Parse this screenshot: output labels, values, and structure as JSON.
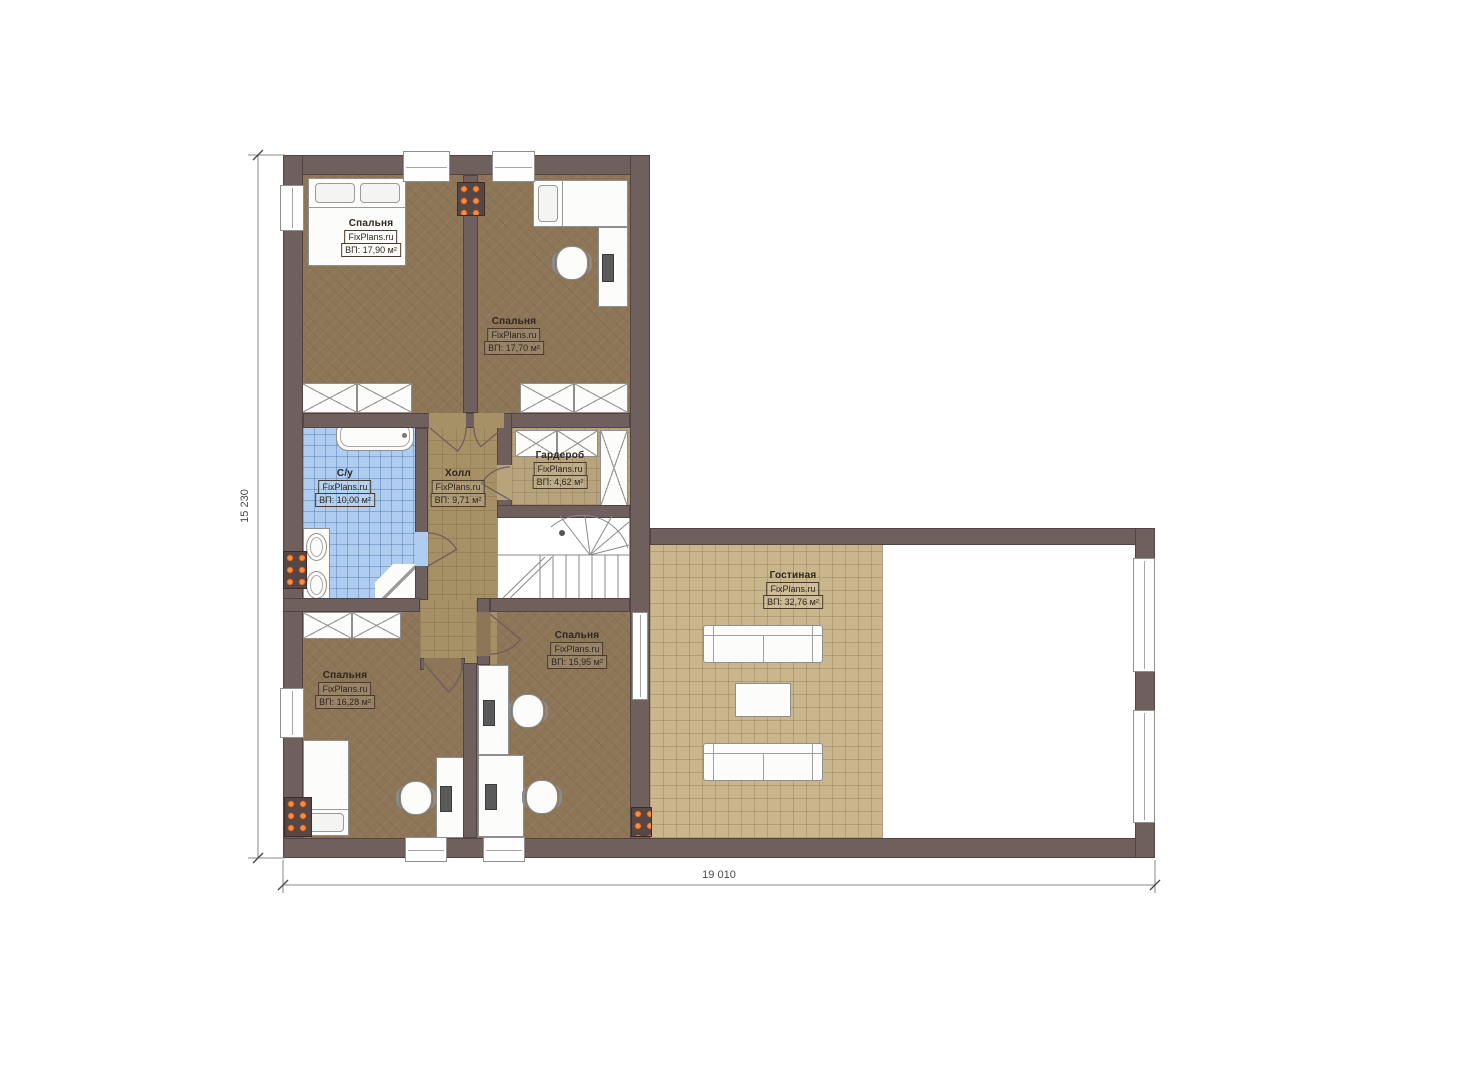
{
  "watermark": "FixPlans.ru",
  "dimensions": {
    "height": "15 230",
    "width": "19 010"
  },
  "rooms": [
    {
      "name": "Спальня",
      "brand": "FixPlans.ru",
      "area": "ВП: 17,90 м²"
    },
    {
      "name": "Спальня",
      "brand": "FixPlans.ru",
      "area": "ВП: 17,70 м²"
    },
    {
      "name": "С/у",
      "brand": "FixPlans.ru",
      "area": "ВП: 10,00 м²"
    },
    {
      "name": "Холл",
      "brand": "FixPlans.ru",
      "area": "ВП: 9,71 м²"
    },
    {
      "name": "Гардероб",
      "brand": "FixPlans.ru",
      "area": "ВП: 4,62 м²"
    },
    {
      "name": "Гостиная",
      "brand": "FixPlans.ru",
      "area": "ВП: 32,76 м²"
    },
    {
      "name": "Спальня",
      "brand": "FixPlans.ru",
      "area": "ВП: 15,95 м²"
    },
    {
      "name": "Спальня",
      "brand": "FixPlans.ru",
      "area": "ВП: 16,28 м²"
    }
  ],
  "colors": {
    "wall": "#6f5f5d",
    "bedroom_floor": "#8d7557",
    "hall_floor": "#a69066",
    "wardrobe_floor": "#b7a47c",
    "living_floor": "#c9b68c",
    "bathroom_floor": "#aecdf0",
    "radiator_accent": "#ff8a3c"
  }
}
